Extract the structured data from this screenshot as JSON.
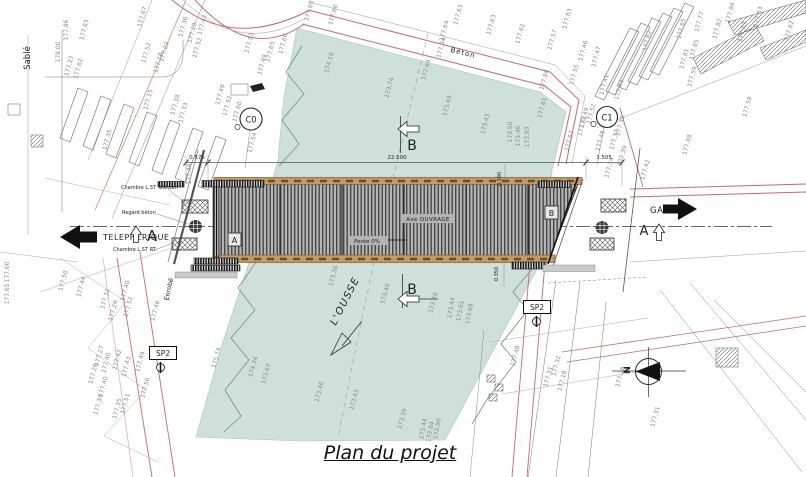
{
  "title": {
    "caption": "Plan du projet"
  },
  "compass": {
    "north": "N"
  },
  "river": {
    "name": "L'OUSSE"
  },
  "directions": {
    "left": {
      "label": "TELEPHERIQUE"
    },
    "right": {
      "label": "GARE"
    }
  },
  "sections": {
    "a_left": "A",
    "a_right": "A",
    "b_top": "B",
    "b_bottom": "B",
    "c0": "C0",
    "c1": "C1"
  },
  "boreholes": {
    "sp2_left": "SP2",
    "sp2_right": "SP2"
  },
  "bridge": {
    "axis_label": "Axe OUVRAGE",
    "slope_label": "Pente 0%",
    "ref_a": "A",
    "ref_b": "B"
  },
  "dimensions": {
    "left_offset": "0.575",
    "span": "22.500",
    "right_offset": "3.505",
    "walkway_top": "0.190",
    "walkway_bottom": "0.350"
  },
  "surface_labels": {
    "sable": "Sablé",
    "beton": "Béton",
    "enrobe": "Enrobé"
  },
  "utility_labels": {
    "chambre_telecom": "Chambre L.ST Télécom",
    "regard_beton": "Regard béton",
    "chambre_rt": "Chambre L.ST RT."
  },
  "colors": {
    "river": "#cfe0db",
    "deck_edge": "#c29a66",
    "road": "#c66a6a"
  },
  "elevation_labels": [
    {
      "t": "178.00",
      "x": 59,
      "y": 52,
      "r": -90
    },
    {
      "t": "177.27",
      "x": 70,
      "y": 66
    },
    {
      "t": "177.62",
      "x": 79,
      "y": 69
    },
    {
      "t": "177.86",
      "x": 67,
      "y": 30,
      "r": -90
    },
    {
      "t": "177.83",
      "x": 85,
      "y": 30
    },
    {
      "t": "177.67",
      "x": 143,
      "y": 17
    },
    {
      "t": "177.52",
      "x": 147,
      "y": 53
    },
    {
      "t": "177.35",
      "x": 108,
      "y": 140
    },
    {
      "t": "177.36",
      "x": 184,
      "y": 27
    },
    {
      "t": "177.29",
      "x": 193,
      "y": 33
    },
    {
      "t": "177.42",
      "x": 203,
      "y": 25
    },
    {
      "t": "177.22",
      "x": 165,
      "y": 52
    },
    {
      "t": "177.18",
      "x": 159,
      "y": 63
    },
    {
      "t": "177.15",
      "x": 149,
      "y": 100
    },
    {
      "t": "177.38",
      "x": 176,
      "y": 105
    },
    {
      "t": "177.33",
      "x": 184,
      "y": 113
    },
    {
      "t": "177.52",
      "x": 198,
      "y": 48
    },
    {
      "t": "177.53",
      "x": 250,
      "y": 43
    },
    {
      "t": "177.49",
      "x": 263,
      "y": 65
    },
    {
      "t": "177.65",
      "x": 271,
      "y": 52
    },
    {
      "t": "177.66",
      "x": 284,
      "y": 44
    },
    {
      "t": "177.49",
      "x": 221,
      "y": 95
    },
    {
      "t": "177.52",
      "x": 228,
      "y": 106
    },
    {
      "t": "177.60",
      "x": 238,
      "y": 112
    },
    {
      "t": "177.54",
      "x": 253,
      "y": 143
    },
    {
      "t": "177.44",
      "x": 190,
      "y": 174,
      "r": -90
    },
    {
      "t": "177.68",
      "x": 310,
      "y": 11
    },
    {
      "t": "177.66",
      "x": 334,
      "y": 15
    },
    {
      "t": "177.64",
      "x": 445,
      "y": 31
    },
    {
      "t": "177.63",
      "x": 459,
      "y": 15
    },
    {
      "t": "177.63",
      "x": 492,
      "y": 25
    },
    {
      "t": "177.62",
      "x": 521,
      "y": 34
    },
    {
      "t": "177.84",
      "x": 442,
      "y": 48
    },
    {
      "t": "177.64",
      "x": 427,
      "y": 70
    },
    {
      "t": "177.63",
      "x": 568,
      "y": 19
    },
    {
      "t": "177.57",
      "x": 553,
      "y": 40
    },
    {
      "t": "177.88",
      "x": 545,
      "y": 80
    },
    {
      "t": "177.61",
      "x": 543,
      "y": 108
    },
    {
      "t": "177.62",
      "x": 790,
      "y": 31
    },
    {
      "t": "177.63",
      "x": 759,
      "y": 17
    },
    {
      "t": "177.62",
      "x": 648,
      "y": 41
    },
    {
      "t": "177.46",
      "x": 584,
      "y": 51
    },
    {
      "t": "177.47",
      "x": 597,
      "y": 57
    },
    {
      "t": "177.55",
      "x": 575,
      "y": 75
    },
    {
      "t": "177.41",
      "x": 605,
      "y": 85
    },
    {
      "t": "177.43",
      "x": 620,
      "y": 90
    },
    {
      "t": "177.65",
      "x": 682,
      "y": 29
    },
    {
      "t": "177.77",
      "x": 700,
      "y": 22
    },
    {
      "t": "177.82",
      "x": 718,
      "y": 29
    },
    {
      "t": "177.94",
      "x": 731,
      "y": 13
    },
    {
      "t": "177.83",
      "x": 743,
      "y": 32
    },
    {
      "t": "177.85",
      "x": 695,
      "y": 50
    },
    {
      "t": "177.81",
      "x": 685,
      "y": 59
    },
    {
      "t": "177.59",
      "x": 693,
      "y": 77
    },
    {
      "t": "177.59",
      "x": 748,
      "y": 107
    },
    {
      "t": "177.52",
      "x": 592,
      "y": 114
    },
    {
      "t": "177.61",
      "x": 583,
      "y": 126
    },
    {
      "t": "177.39",
      "x": 621,
      "y": 126
    },
    {
      "t": "177.49",
      "x": 585,
      "y": 118
    },
    {
      "t": "177.67",
      "x": 570,
      "y": 141
    },
    {
      "t": "177.48",
      "x": 601,
      "y": 141
    },
    {
      "t": "177.37",
      "x": 615,
      "y": 140
    },
    {
      "t": "177.34",
      "x": 610,
      "y": 168
    },
    {
      "t": "177.39",
      "x": 623,
      "y": 156
    },
    {
      "t": "177.42",
      "x": 646,
      "y": 170
    },
    {
      "t": "177.48",
      "x": 688,
      "y": 145
    },
    {
      "t": "174.18",
      "x": 330,
      "y": 63
    },
    {
      "t": "173.74",
      "x": 390,
      "y": 88
    },
    {
      "t": "173.49",
      "x": 448,
      "y": 106
    },
    {
      "t": "173.43",
      "x": 486,
      "y": 124
    },
    {
      "t": "173.50",
      "x": 511,
      "y": 132,
      "r": -90
    },
    {
      "t": "173.46",
      "x": 519,
      "y": 136,
      "r": -90
    },
    {
      "t": "173.93",
      "x": 528,
      "y": 137,
      "r": -90
    },
    {
      "t": "173.38",
      "x": 334,
      "y": 276
    },
    {
      "t": "173.40",
      "x": 386,
      "y": 294
    },
    {
      "t": "173.38",
      "x": 434,
      "y": 303
    },
    {
      "t": "173.44",
      "x": 452,
      "y": 308,
      "r": -80
    },
    {
      "t": "173.61",
      "x": 461,
      "y": 311,
      "r": -80
    },
    {
      "t": "173.68",
      "x": 470,
      "y": 314,
      "r": -80
    },
    {
      "t": "175.74",
      "x": 217,
      "y": 358
    },
    {
      "t": "174.34",
      "x": 254,
      "y": 367
    },
    {
      "t": "173.67",
      "x": 267,
      "y": 374
    },
    {
      "t": "173.46",
      "x": 320,
      "y": 392
    },
    {
      "t": "173.43",
      "x": 355,
      "y": 400
    },
    {
      "t": "173.39",
      "x": 403,
      "y": 419
    },
    {
      "t": "173.44",
      "x": 424,
      "y": 429,
      "r": -80
    },
    {
      "t": "173.84",
      "x": 431,
      "y": 432,
      "r": -80
    },
    {
      "t": "173.90",
      "x": 438,
      "y": 429,
      "r": -80
    },
    {
      "t": "177.60",
      "x": 8,
      "y": 272,
      "r": -90
    },
    {
      "t": "177.65",
      "x": 8,
      "y": 294,
      "r": -90
    },
    {
      "t": "177.50",
      "x": 64,
      "y": 281
    },
    {
      "t": "177.44",
      "x": 82,
      "y": 287
    },
    {
      "t": "177.32",
      "x": 106,
      "y": 299
    },
    {
      "t": "177.40",
      "x": 126,
      "y": 291
    },
    {
      "t": "177.29",
      "x": 114,
      "y": 311
    },
    {
      "t": "177.52",
      "x": 129,
      "y": 307
    },
    {
      "t": "177.46",
      "x": 156,
      "y": 311
    },
    {
      "t": "177.27",
      "x": 100,
      "y": 356
    },
    {
      "t": "177.40",
      "x": 107,
      "y": 363
    },
    {
      "t": "177.42",
      "x": 118,
      "y": 360
    },
    {
      "t": "177.43",
      "x": 127,
      "y": 367
    },
    {
      "t": "177.49",
      "x": 141,
      "y": 362
    },
    {
      "t": "177.26",
      "x": 94,
      "y": 374
    },
    {
      "t": "177.40",
      "x": 104,
      "y": 387
    },
    {
      "t": "177.56",
      "x": 146,
      "y": 388
    },
    {
      "t": "177.34",
      "x": 99,
      "y": 405
    },
    {
      "t": "177.35",
      "x": 118,
      "y": 409
    },
    {
      "t": "177.51",
      "x": 126,
      "y": 404
    },
    {
      "t": "177.48",
      "x": 516,
      "y": 356
    },
    {
      "t": "177.31",
      "x": 549,
      "y": 377
    },
    {
      "t": "177.32",
      "x": 557,
      "y": 366
    },
    {
      "t": "177.16",
      "x": 563,
      "y": 381
    },
    {
      "t": "177.26",
      "x": 621,
      "y": 377
    },
    {
      "t": "177.31",
      "x": 656,
      "y": 417
    }
  ]
}
